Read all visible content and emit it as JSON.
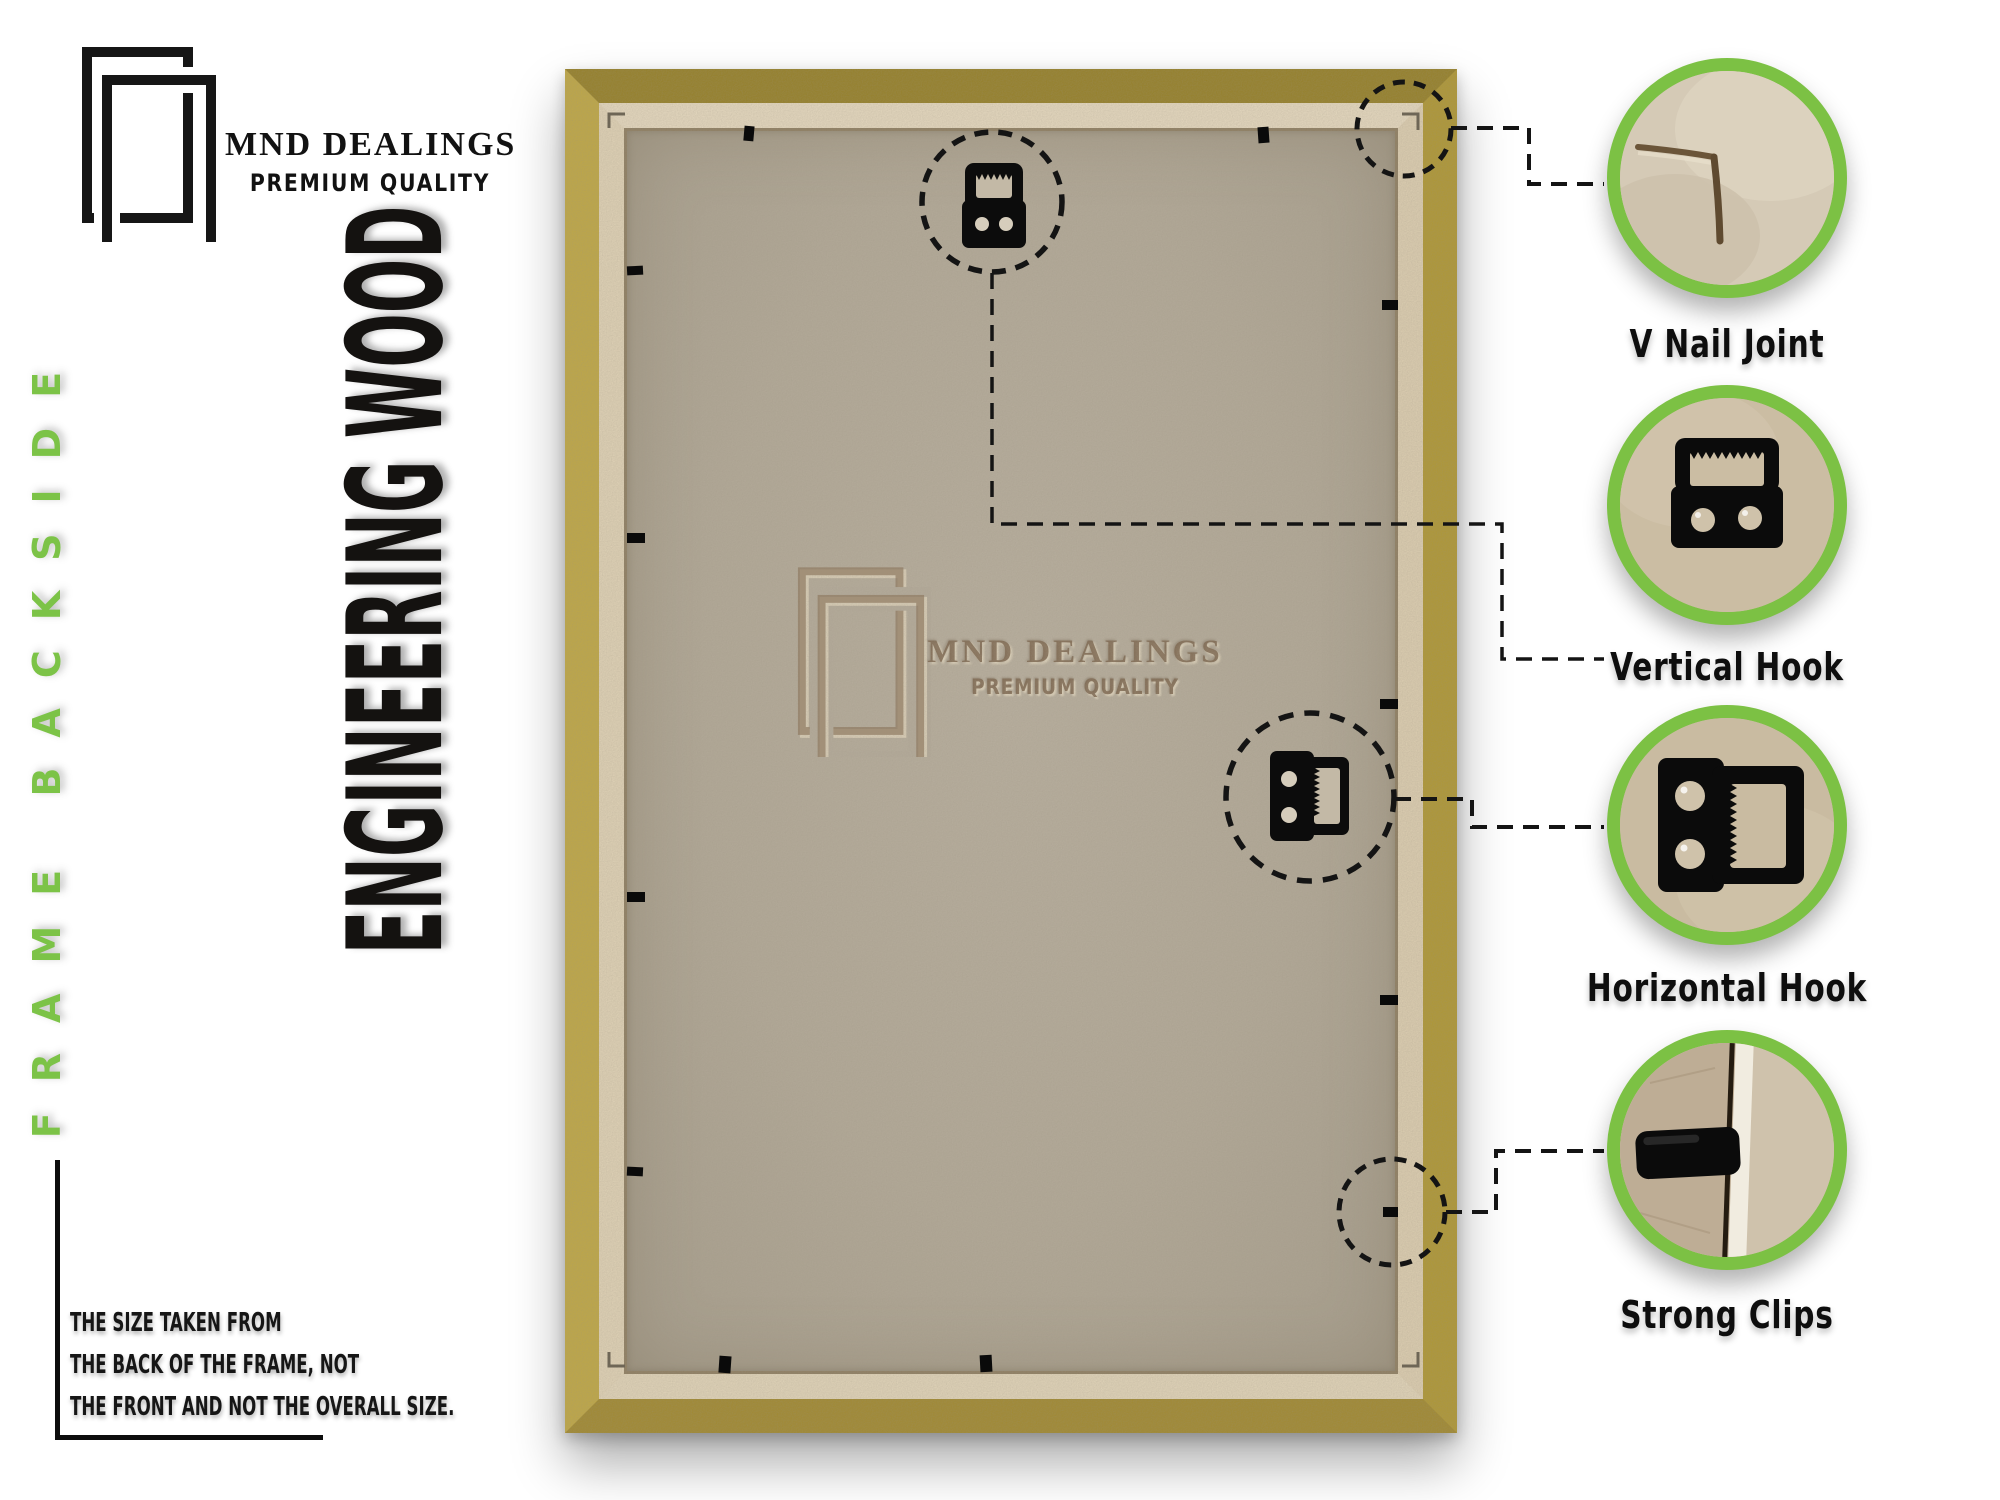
{
  "brand": {
    "name": "MND DEALINGS",
    "tagline": "PREMIUM QUALITY"
  },
  "banners": {
    "side": "FRAME BACKSIDE",
    "material": "ENGINEERING WOOD"
  },
  "watermark": {
    "name": "MND DEALINGS",
    "tagline": "PREMIUM QUALITY"
  },
  "callouts": [
    {
      "id": "v-nail-joint",
      "label": "V Nail Joint"
    },
    {
      "id": "vertical-hook",
      "label": "Vertical Hook"
    },
    {
      "id": "horizontal-hook",
      "label": "Horizontal Hook"
    },
    {
      "id": "strong-clips",
      "label": "Strong Clips"
    }
  ],
  "note": {
    "lines": [
      "THE SIZE TAKEN FROM",
      "THE BACK OF THE FRAME, NOT",
      "THE FRONT AND NOT THE OVERALL SIZE."
    ]
  },
  "colors": {
    "accent_green": "#7cc144",
    "gold_light": "#c3aa3e",
    "gold_dark": "#957e1e",
    "cream_lip": "#e9dcc0",
    "mdf": "#b5ac9b",
    "ink": "#111111"
  }
}
